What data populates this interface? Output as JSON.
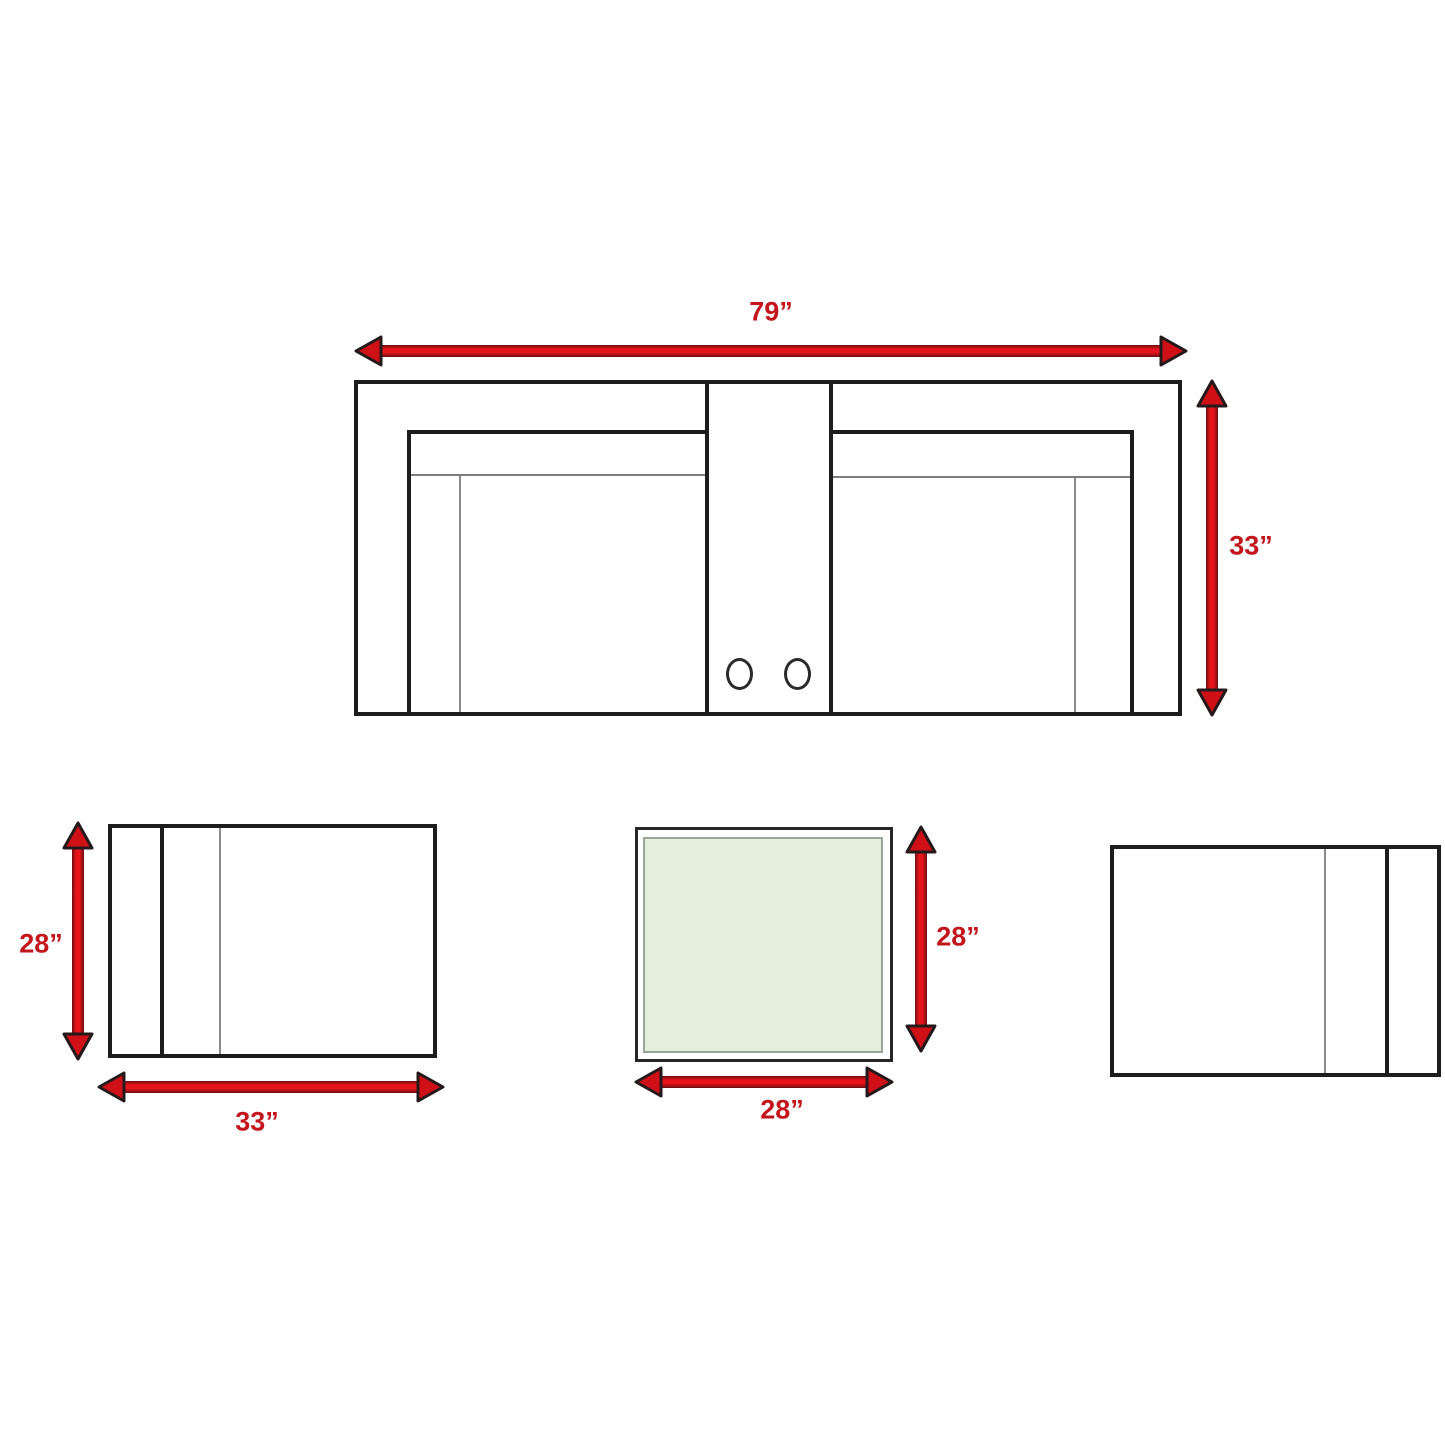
{
  "diagram_type": "furniture-dimension-diagram",
  "colors": {
    "arrow_red_bright": "#e8141b",
    "arrow_red_dark": "#6d0e12",
    "arrowhead_fill": "#cf1016",
    "arrowhead_stroke": "#241a1b",
    "label_red": "#c3161c",
    "line_black": "#1d1d1d",
    "line_gray": "#8a8a8a",
    "table_glass_green": "#e3efdc"
  },
  "sofa": {
    "description": "loveseat top view with center console and two cup holders",
    "width_label": "79”",
    "depth_label": "33”"
  },
  "chair_left": {
    "description": "chair top view, arm on left",
    "depth_label": "28”",
    "width_label": "33”"
  },
  "table": {
    "description": "square table top view with glass top",
    "depth_label": "28”",
    "width_label": "28”"
  },
  "chair_right": {
    "description": "chair top view, arm on right, no labels"
  }
}
